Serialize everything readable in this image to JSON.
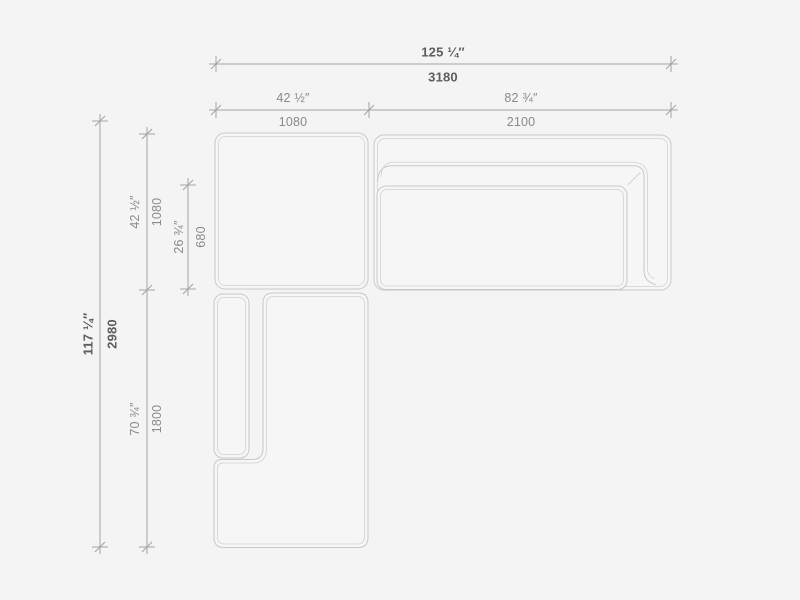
{
  "drawing": {
    "type": "sectional-sofa-top-view-technical-drawing",
    "background_color": "#f4f4f4",
    "outline_color": "#c8c8c8",
    "inner_outline_color": "#d9d9d9",
    "dimension_line_color": "#a3a3a3",
    "dimensions": {
      "overall_width": {
        "imperial": "125 ¼″",
        "metric": "3180"
      },
      "corner_module_width": {
        "imperial": "42 ½″",
        "metric": "1080"
      },
      "sofa_module_width": {
        "imperial": "82 ¾″",
        "metric": "2100"
      },
      "overall_depth": {
        "imperial": "117 ¼″",
        "metric": "2980"
      },
      "corner_module_depth": {
        "imperial": "42 ½″",
        "metric": "1080"
      },
      "seat_depth": {
        "imperial": "26 ¾″",
        "metric": "680"
      },
      "chaise_module_length": {
        "imperial": "70 ¾″",
        "metric": "1800"
      }
    }
  }
}
